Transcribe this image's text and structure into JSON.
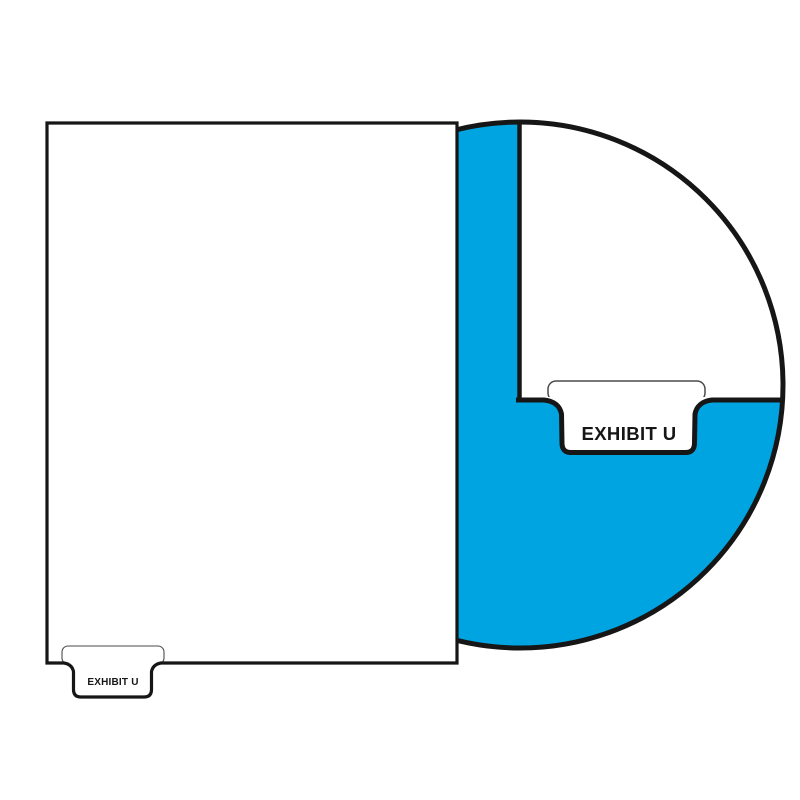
{
  "sheet": {
    "tab_label": "EXHIBIT U"
  },
  "magnifier": {
    "tab_label": "EXHIBIT U"
  },
  "colors": {
    "tab_blue": "#00A4E0",
    "outline": "#161616",
    "paper": "#FFFFFF",
    "flap_outline": "#4A4A4A"
  }
}
